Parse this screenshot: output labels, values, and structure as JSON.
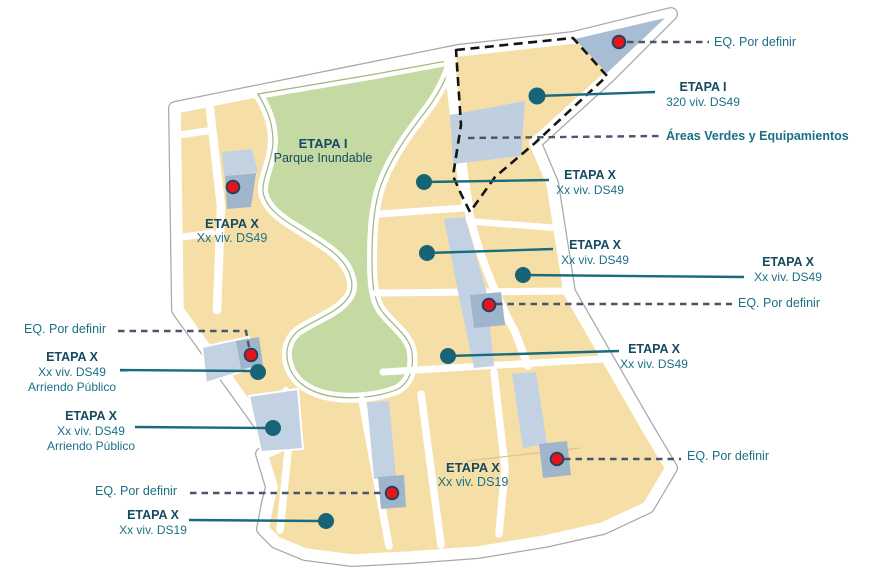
{
  "on_map": {
    "park": {
      "title": "ETAPA I",
      "subtitle": "Parque Inundable"
    },
    "west_block": {
      "title": "ETAPA X",
      "subtitle": "Xx viv. DS49"
    },
    "south_block": {
      "title": "ETAPA X",
      "subtitle": "Xx viv. DS19"
    }
  },
  "callouts": {
    "eq_top_right": {
      "text": "EQ. Por definir"
    },
    "etapa_i": {
      "title": "ETAPA I",
      "subtitle": "320 viv. DS49"
    },
    "areas_verdes": {
      "text": "Áreas Verdes  y Equipamientos"
    },
    "etapa_x_1": {
      "title": "ETAPA X",
      "subtitle": "Xx viv. DS49"
    },
    "etapa_x_2": {
      "title": "ETAPA X",
      "subtitle": "Xx viv. DS49"
    },
    "etapa_x_3": {
      "title": "ETAPA X",
      "subtitle": "Xx viv. DS49"
    },
    "eq_right": {
      "text": "EQ. Por definir"
    },
    "etapa_x_4": {
      "title": "ETAPA X",
      "subtitle": "Xx viv. DS49"
    },
    "eq_bottom_right": {
      "text": "EQ. Por definir"
    },
    "eq_left": {
      "text": "EQ. Por definir"
    },
    "etapa_x_arr_1": {
      "title": "ETAPA X",
      "subtitle": "Xx viv. DS49",
      "line3": "Arriendo Público"
    },
    "etapa_x_arr_2": {
      "title": "ETAPA X",
      "subtitle": "Xx viv. DS49",
      "line3": "Arriendo Público"
    },
    "eq_bottom_left": {
      "text": "EQ. Por definir"
    },
    "etapa_x_ds19": {
      "title": "ETAPA X",
      "subtitle": "Xx viv. DS19"
    }
  },
  "markers": {
    "red_dot_count": 6,
    "teal_dot_count": 8,
    "red_dot_meaning": "EQ. Por definir",
    "teal_dot_meaning": "ETAPA leader anchor"
  },
  "colors": {
    "block_fill": "#F6DFA7",
    "park_fill": "#C5DAA2",
    "equipment_strip": "#C3D2E2",
    "equipment_cell": "#9FB5CC",
    "triangle_fill": "#A7BDD3",
    "road": "#FFFFFF",
    "leader_solid": "#1A6B7E",
    "leader_dashed": "#47566C",
    "stage1_boundary": "#141414",
    "red_marker": "#E8141C",
    "label_dark": "#164A60",
    "label_teal": "#1B7086"
  }
}
